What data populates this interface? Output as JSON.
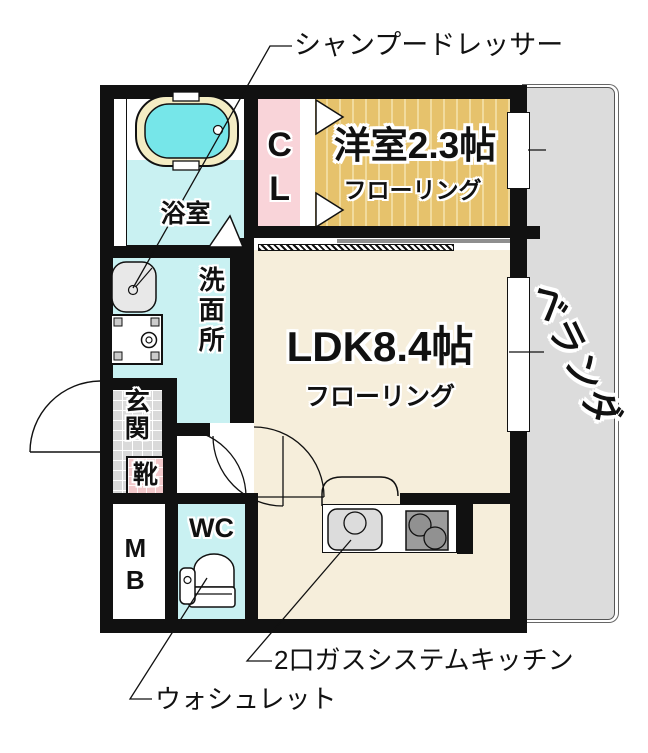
{
  "floor_plan": {
    "callouts": {
      "shampoo_dresser": "シャンプードレッサー",
      "gas_kitchen": "2口ガスシステムキッチン",
      "washlet": "ウォシュレット"
    },
    "rooms": {
      "western_room": {
        "name": "洋室2.3帖",
        "floor": "フローリング"
      },
      "ldk": {
        "name": "LDK8.4帖",
        "floor": "フローリング"
      },
      "bathroom": "浴室",
      "washroom": "洗面所",
      "closet": "CL",
      "entrance": "玄関",
      "shoe_cabinet": "靴",
      "toilet": "WC",
      "meter_box": "MB",
      "veranda": "ベランダ"
    },
    "colors": {
      "wall": "#111111",
      "water_rooms": "#c9f1f2",
      "tub_water": "#76e6e9",
      "tub_rim": "#f4edc4",
      "closet_pink": "#f9d4d9",
      "western_floor": "#e6c26c",
      "ldk_floor": "#f6eedb",
      "veranda_gray": "#dcdcdc",
      "entrance_tile": "#dadada"
    }
  }
}
